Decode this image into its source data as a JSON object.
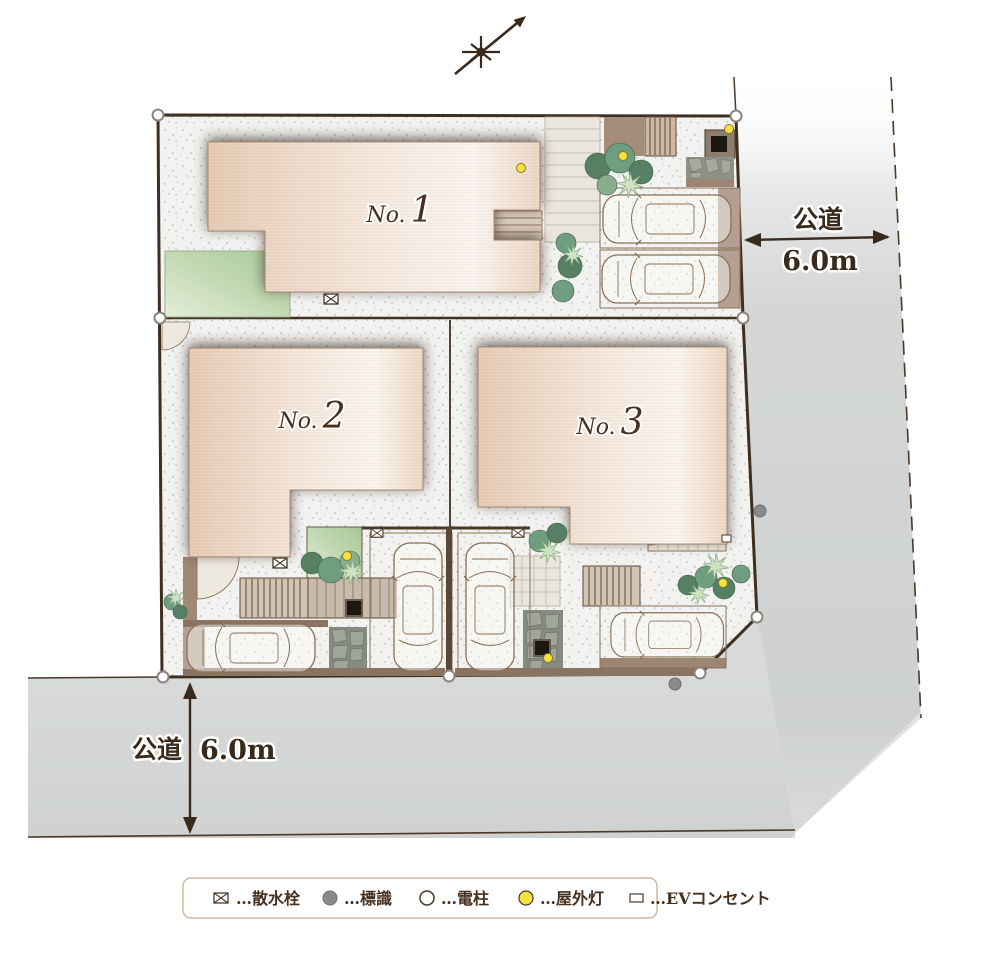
{
  "plan": {
    "houses": [
      {
        "prefix": "No.",
        "number": "1"
      },
      {
        "prefix": "No.",
        "number": "2"
      },
      {
        "prefix": "No.",
        "number": "3"
      }
    ],
    "dimensions": {
      "right": {
        "road_label": "公道",
        "width_label": "6.0m"
      },
      "bottom": {
        "road_label": "公道",
        "width_label": "6.0m"
      }
    },
    "legend": {
      "items": [
        {
          "icon": "sprinkler-symbol",
          "label": "…散水栓"
        },
        {
          "icon": "sign-symbol",
          "label": "…標識"
        },
        {
          "icon": "pole-symbol",
          "label": "…電柱"
        },
        {
          "icon": "outdoor-light-symbol",
          "label": "…屋外灯"
        },
        {
          "icon": "ev-outlet-symbol",
          "label": "…EVコンセント"
        }
      ]
    },
    "colors": {
      "boundary_line": "#3f2f21",
      "road_gray": "#d3d6d5",
      "house_peach": "#e8cdb7",
      "lawn_green": "#a7c796",
      "outdoor_light_yellow": "#f4e23e",
      "sign_gray": "#8a8a8a"
    }
  }
}
